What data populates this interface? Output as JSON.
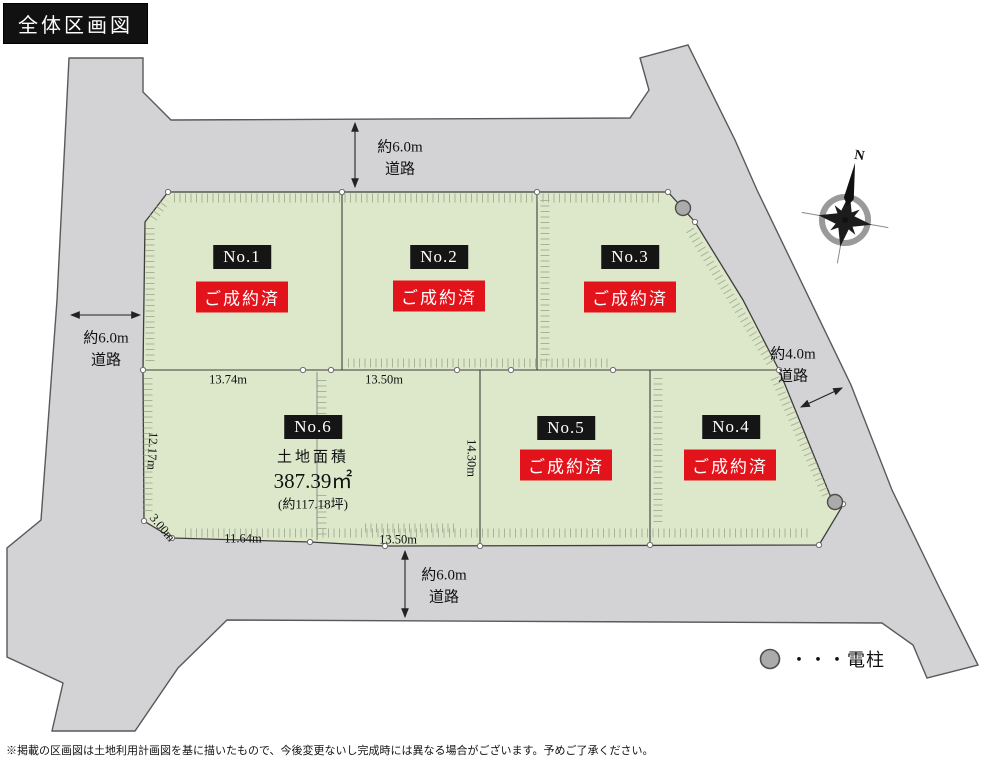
{
  "title": "全体区画図",
  "compass": {
    "north": "N"
  },
  "roads": {
    "top": {
      "line1": "約6.0m",
      "line2": "道路"
    },
    "left": {
      "line1": "約6.0m",
      "line2": "道路"
    },
    "bottom": {
      "line1": "約6.0m",
      "line2": "道路"
    },
    "right": {
      "line1": "約4.0m",
      "line2": "道路"
    }
  },
  "lots": [
    {
      "id": "No.1",
      "status": "ご成約済"
    },
    {
      "id": "No.2",
      "status": "ご成約済"
    },
    {
      "id": "No.3",
      "status": "ご成約済"
    },
    {
      "id": "No.4",
      "status": "ご成約済"
    },
    {
      "id": "No.5",
      "status": "ご成約済"
    },
    {
      "id": "No.6",
      "area_title": "土地面積",
      "area_value": "387.39㎡",
      "area_tsubo": "(約117.18坪)"
    }
  ],
  "dimensions": {
    "lot6_top": "13.74m",
    "lot6_top_right": "13.50m",
    "lot6_left": "12.17m",
    "lot6_corner": "3.00m",
    "lot6_bottom": "11.64m",
    "lot5_bottom": "13.50m",
    "lot5_left": "14.30m"
  },
  "legend": {
    "pole": "・・・電柱"
  },
  "disclaimer": "※掲載の区画図は土地利用計画図を基に描いたもので、今後変更ないし完成時には異なる場合がございます。予めご了承ください。",
  "colors": {
    "lot_fill": "#dde8cb",
    "road_fill": "#d3d3d5",
    "sold_red": "#e3131b",
    "label_black": "#151515"
  }
}
